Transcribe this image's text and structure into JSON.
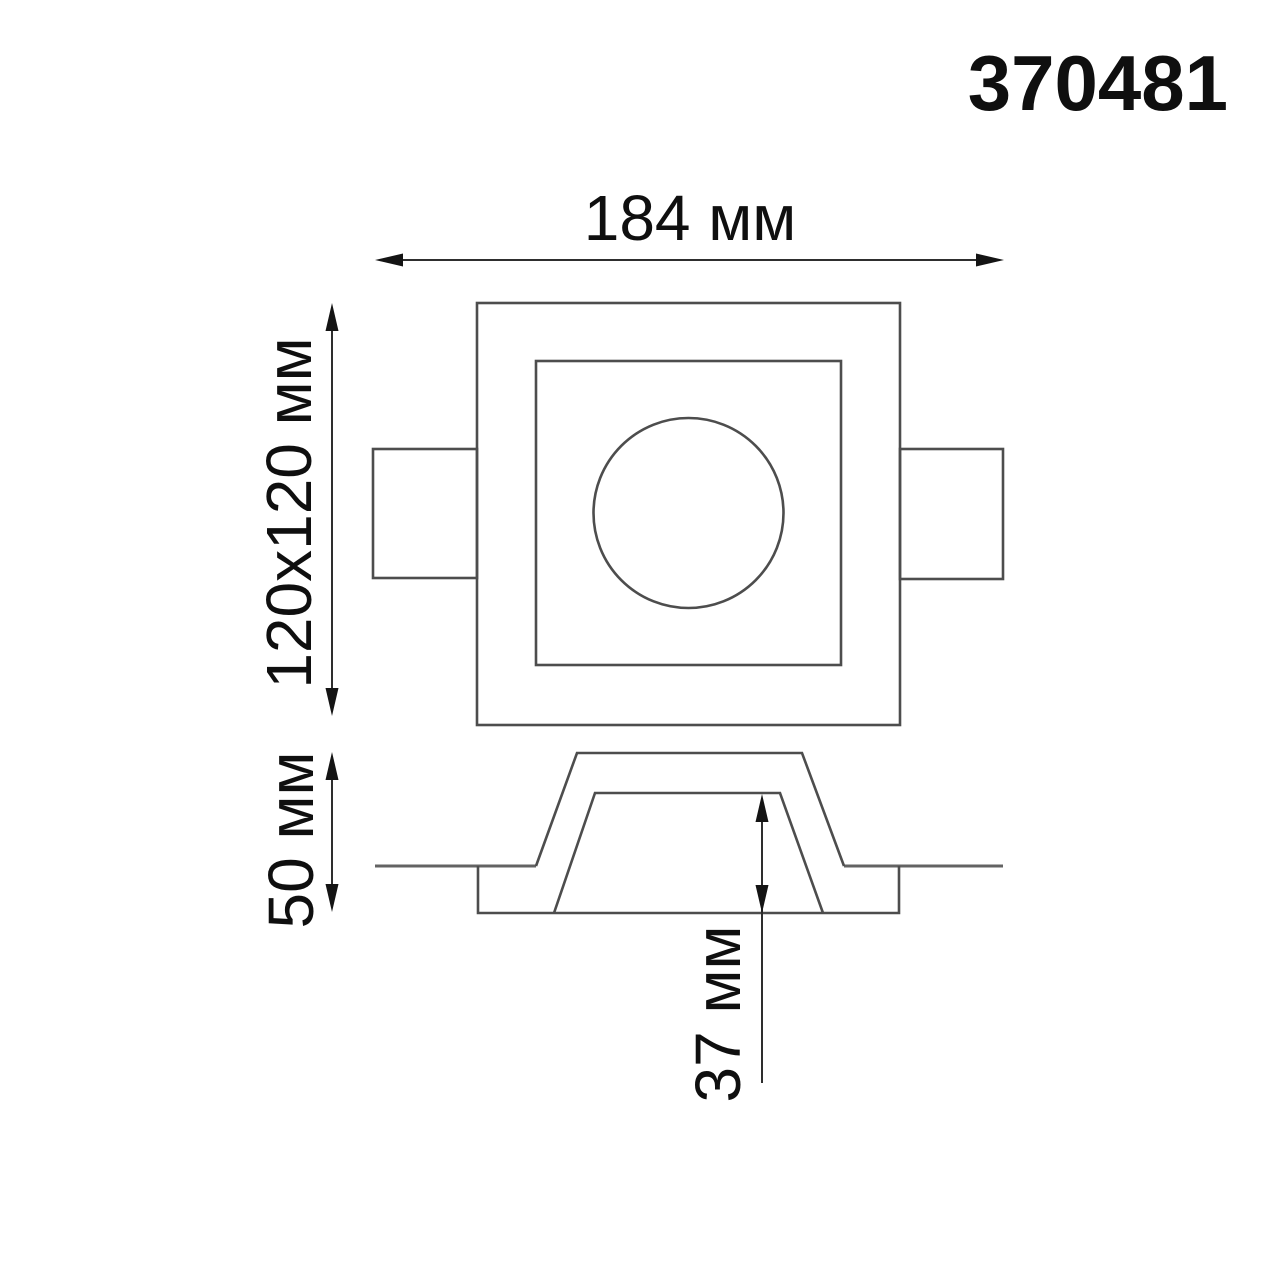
{
  "title": "370481",
  "dimensions": {
    "width": "184 мм",
    "face": "120x120 мм",
    "height": "50 мм",
    "depth": "37 мм"
  },
  "colors": {
    "background": "#ffffff",
    "geometry_line": "#4d4d4d",
    "dimension_line": "#2e2e2e",
    "text": "#0f0f0f"
  }
}
